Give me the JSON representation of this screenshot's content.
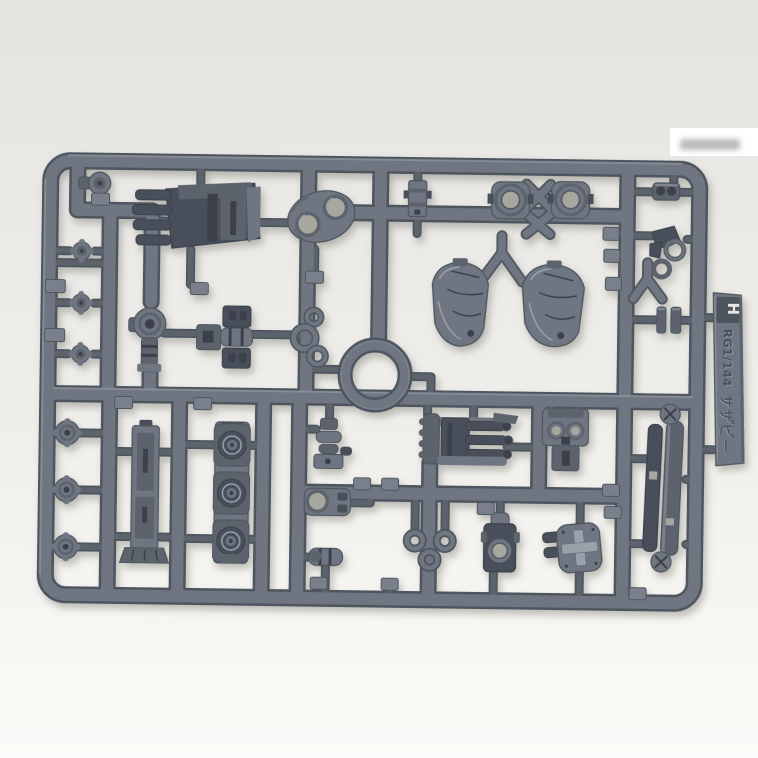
{
  "meta": {
    "subject": "Plastic model kit runner sprue with molded mecha parts photographed on a light gray studio background",
    "view": "top-down product photo, single gray-blue injection runner"
  },
  "colors": {
    "bg_top": "#e4e3df",
    "bg_upper": "#e8e7e3",
    "bg_mid": "#efeeea",
    "bg_low": "#f7f6f2",
    "bg_bottom": "#fbfbf9",
    "plastic_light": "#9aa1ab",
    "plastic_mid": "#6f7681",
    "plastic_shade": "#5c636d",
    "plastic_edge": "#4d545e",
    "plastic_dark": "#4a505a",
    "plastic_deep": "#3b414b",
    "hole_light": "#a6a79f",
    "tag_face": "#79808b",
    "watermark_white": "#ffffff",
    "watermark_gray": "#a9a9a9",
    "shadow": "#66665f"
  },
  "runner_tab": {
    "runner_letter": "H",
    "label_scale": "RG1/144",
    "label_kit": "サザビー"
  },
  "parts": [
    "corner-knob",
    "backpack-thruster-unit",
    "armor-plate-two-holes",
    "poly-cap-connector",
    "joint-lens-left",
    "joint-lens-right",
    "twin-tube-block",
    "claw-and-rings-cluster",
    "pin-pair",
    "shoulder-armor-shell-left",
    "shoulder-armor-shell-right",
    "y-runner-connectors",
    "mono-eye-ball-joint",
    "double-socket-block",
    "ring-trio-small",
    "center-o-ring",
    "star-knobs-left-column",
    "gear-knobs-bottom-left",
    "leg-frame-beam",
    "triple-thruster-stack",
    "elbow-joint-segment",
    "grenade-rack-block",
    "sensor-face-plate",
    "eyelet-plate",
    "small-cylinder",
    "ring-trio-triangle",
    "barrel-clamp",
    "cross-emboss-cap",
    "propellant-tank-halves",
    "runner-id-tab",
    "gate-number-tags",
    "blurred-watermark-patch"
  ]
}
